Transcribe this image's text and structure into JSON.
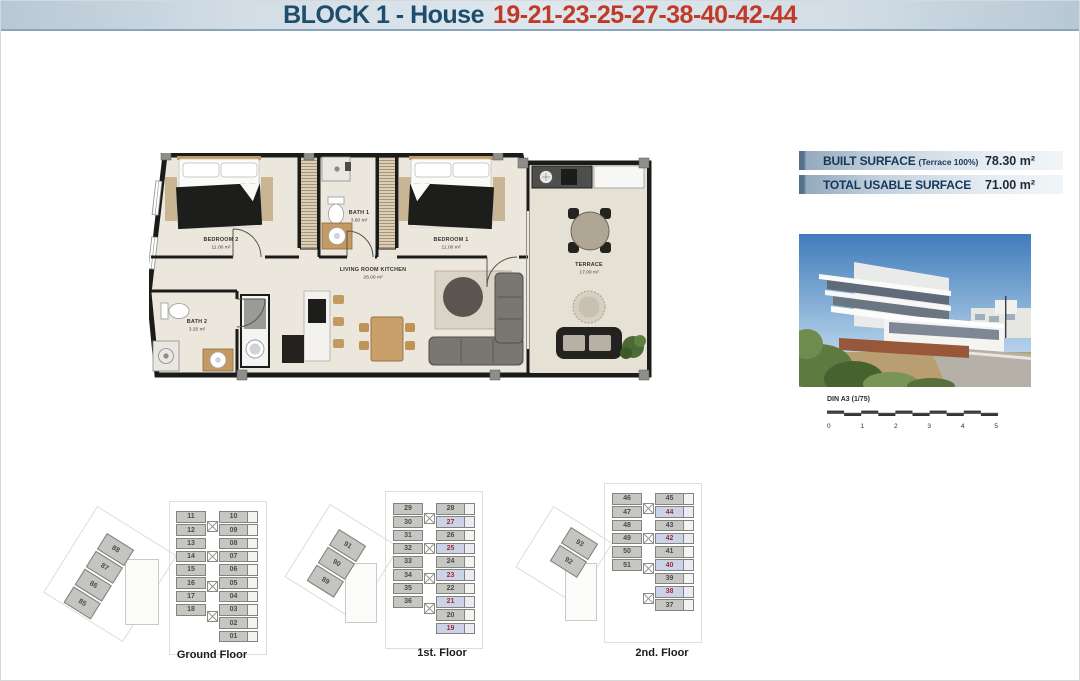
{
  "header": {
    "title_block": "BLOCK 1 - House",
    "title_numbers": "19-21-23-25-27-38-40-42-44"
  },
  "surface_table": {
    "rows": [
      {
        "label": "BUILT SURFACE",
        "note": "(Terrace 100%)",
        "value": "78.30 m²"
      },
      {
        "label": "TOTAL USABLE SURFACE",
        "note": "",
        "value": "71.00 m²"
      }
    ]
  },
  "floor_plan": {
    "rooms": [
      {
        "name": "BEDROOM 2",
        "area": "11.00 m²"
      },
      {
        "name": "BATH 1",
        "area": "3.80 m²"
      },
      {
        "name": "BEDROOM 1",
        "area": "11.00 m²"
      },
      {
        "name": "LIVING ROOM KITCHEN",
        "area": "26.00 m²"
      },
      {
        "name": "BATH 2",
        "area": "3.20 m²"
      },
      {
        "name": "TERRACE",
        "area": "17.00 m²"
      }
    ]
  },
  "scale_bar": {
    "label": "DIN A3 (1/75)",
    "ticks": [
      "0",
      "1",
      "2",
      "3",
      "4",
      "5"
    ]
  },
  "floors": [
    {
      "label": "Ground Floor",
      "diagonal_units": [
        {
          "n": "88"
        },
        {
          "n": "87"
        },
        {
          "n": "86"
        },
        {
          "n": "85"
        }
      ],
      "col_a": [
        {
          "n": "11"
        },
        {
          "n": "12"
        },
        {
          "n": "13"
        },
        {
          "n": "14"
        },
        {
          "n": "15"
        },
        {
          "n": "16"
        },
        {
          "n": "17"
        },
        {
          "n": "18"
        }
      ],
      "col_b": [
        {
          "n": "10"
        },
        {
          "n": "09"
        },
        {
          "n": "08"
        },
        {
          "n": "07"
        },
        {
          "n": "06"
        },
        {
          "n": "05"
        },
        {
          "n": "04"
        },
        {
          "n": "03"
        },
        {
          "n": "02"
        },
        {
          "n": "01"
        }
      ]
    },
    {
      "label": "1st. Floor",
      "diagonal_units": [
        {
          "n": "91"
        },
        {
          "n": "90"
        },
        {
          "n": "89"
        }
      ],
      "col_a": [
        {
          "n": "29"
        },
        {
          "n": "30"
        },
        {
          "n": "31"
        },
        {
          "n": "32"
        },
        {
          "n": "33"
        },
        {
          "n": "34"
        },
        {
          "n": "35"
        },
        {
          "n": "36"
        }
      ],
      "col_b": [
        {
          "n": "28"
        },
        {
          "n": "27",
          "hl": true
        },
        {
          "n": "26"
        },
        {
          "n": "25",
          "hl": true
        },
        {
          "n": "24"
        },
        {
          "n": "23",
          "hl": true
        },
        {
          "n": "22"
        },
        {
          "n": "21",
          "hl": true
        },
        {
          "n": "20"
        },
        {
          "n": "19",
          "hl": true
        }
      ]
    },
    {
      "label": "2nd. Floor",
      "diagonal_units": [
        {
          "n": "93"
        },
        {
          "n": "92"
        }
      ],
      "col_a": [
        {
          "n": "46"
        },
        {
          "n": "47"
        },
        {
          "n": "48"
        },
        {
          "n": "49"
        },
        {
          "n": "50"
        },
        {
          "n": "51"
        }
      ],
      "col_b": [
        {
          "n": "45"
        },
        {
          "n": "44",
          "hl": true
        },
        {
          "n": "43"
        },
        {
          "n": "42",
          "hl": true
        },
        {
          "n": "41"
        },
        {
          "n": "40",
          "hl": true
        },
        {
          "n": "39"
        },
        {
          "n": "38",
          "hl": true
        },
        {
          "n": "37"
        }
      ]
    }
  ],
  "colors": {
    "header_blue": "#1d4d6b",
    "header_red": "#c13a28",
    "table_navy": "#14385c",
    "unit_gray": "#c6c6c3",
    "unit_highlight_bg": "#ccd3e9",
    "unit_highlight_text": "#9c2d33",
    "plan_floor": "#ebe7dd"
  }
}
